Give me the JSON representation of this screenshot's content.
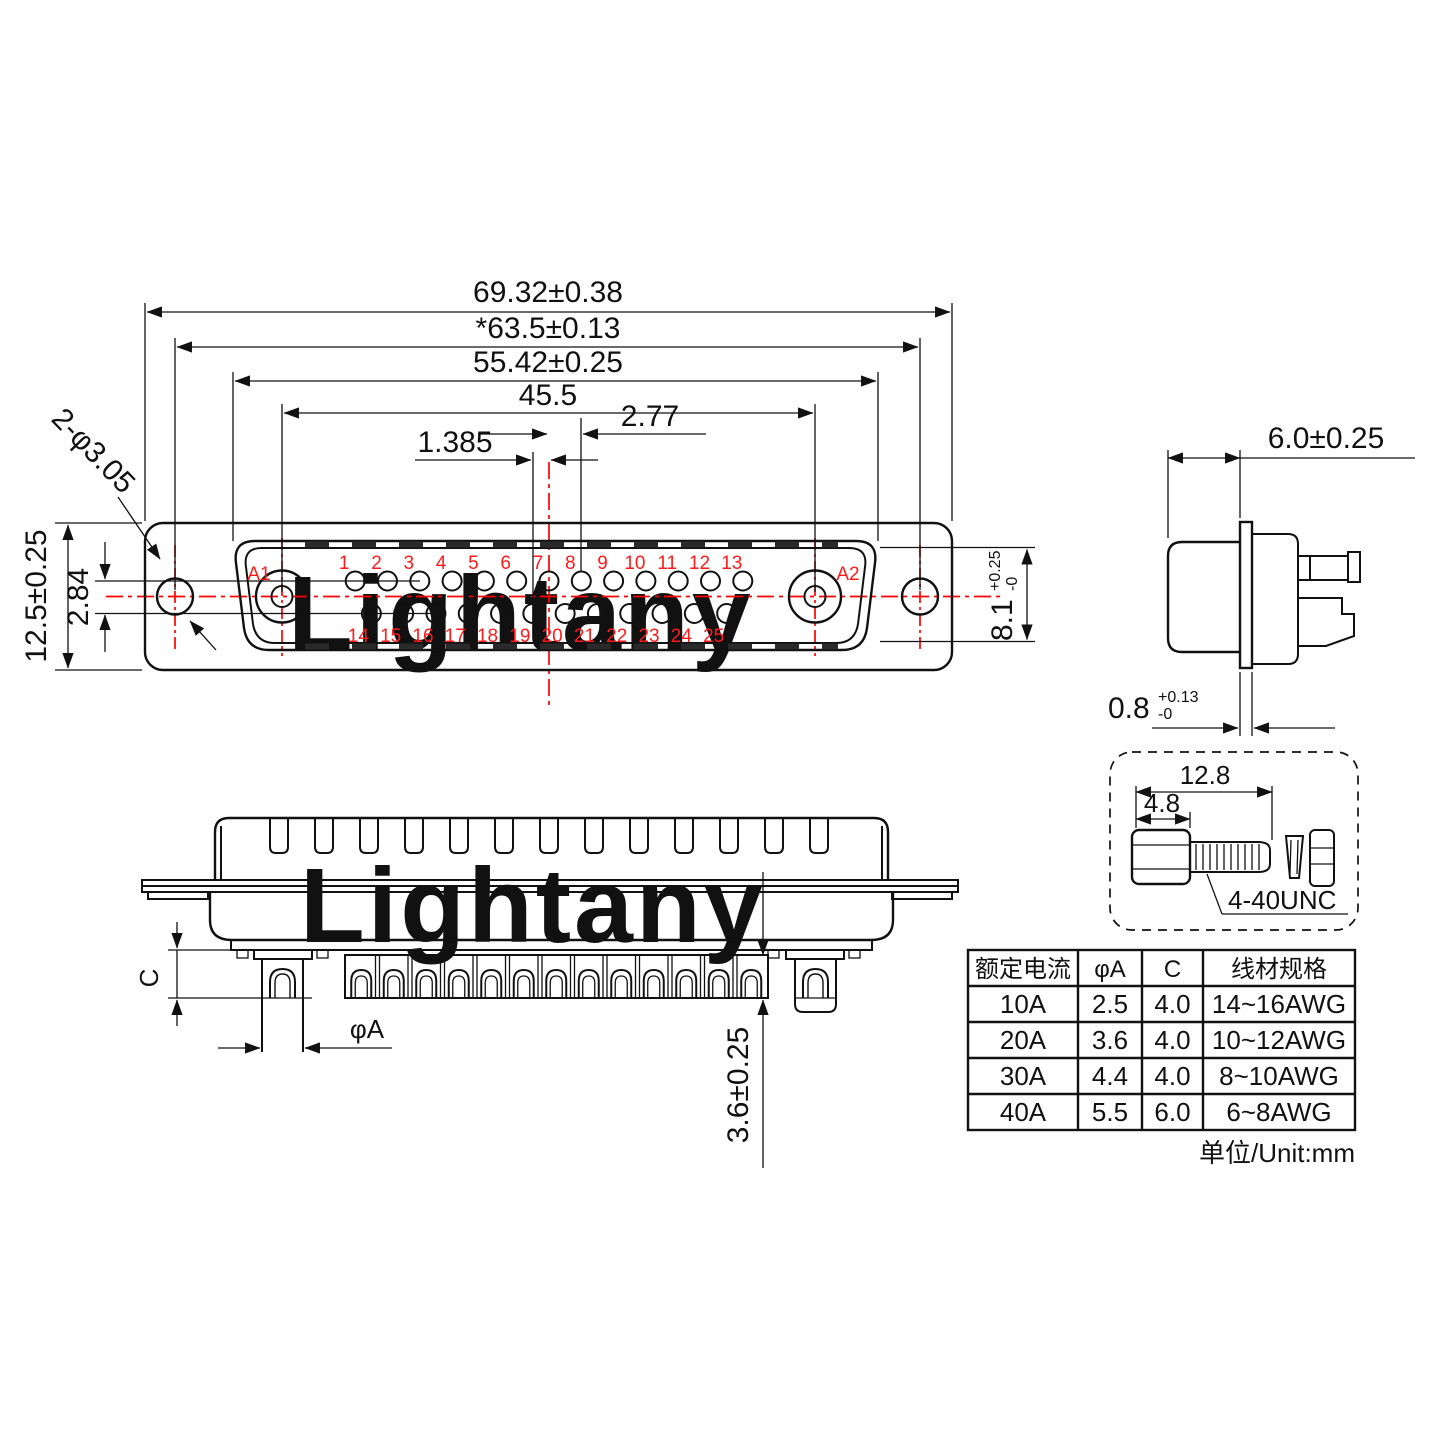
{
  "watermark": {
    "text": "Lightany",
    "color": "#f8d8d8"
  },
  "colors": {
    "line": "#111111",
    "accent_red": "#ff0000",
    "watermark_pink": "#f8d8d8"
  },
  "front_view": {
    "dims": {
      "overall_width": "69.32±0.38",
      "mount_hole_span": "*63.5±0.13",
      "slot_width": "55.42±0.25",
      "power_pin_span": "45.5",
      "pin_pitch": "2.77",
      "half_pitch": "1.385",
      "mount_holes": "2-φ3.05",
      "body_height": "12.5±0.25",
      "row_offset": "2.84",
      "slot_height_base": "8.1",
      "slot_height_tol_plus": "+0.25",
      "slot_height_tol_minus": "-0"
    },
    "pins": {
      "a1": "A1",
      "a2": "A2",
      "top_row": [
        "1",
        "2",
        "3",
        "4",
        "5",
        "6",
        "7",
        "8",
        "9",
        "10",
        "11",
        "12",
        "13"
      ],
      "bottom_row": [
        "14",
        "15",
        "16",
        "17",
        "18",
        "19",
        "20",
        "21",
        "22",
        "23",
        "24",
        "25"
      ]
    }
  },
  "side_view": {
    "depth": "6.0±0.25",
    "flange_thickness_base": "0.8",
    "flange_tol_plus": "+0.13",
    "flange_tol_minus": "-0"
  },
  "screw_detail": {
    "total_length": "12.8",
    "hex_length": "4.8",
    "thread_spec": "4-40UNC"
  },
  "bottom_view": {
    "dim_c_label": "C",
    "dim_a_label": "φA",
    "tail_length": "3.6±0.25"
  },
  "table": {
    "headers": [
      "额定电流",
      "φA",
      "C",
      "线材规格"
    ],
    "rows": [
      [
        "10A",
        "2.5",
        "4.0",
        "14~16AWG"
      ],
      [
        "20A",
        "3.6",
        "4.0",
        "10~12AWG"
      ],
      [
        "30A",
        "4.4",
        "4.0",
        "8~10AWG"
      ],
      [
        "40A",
        "5.5",
        "6.0",
        "6~8AWG"
      ]
    ],
    "unit_note": "单位/Unit:mm"
  }
}
